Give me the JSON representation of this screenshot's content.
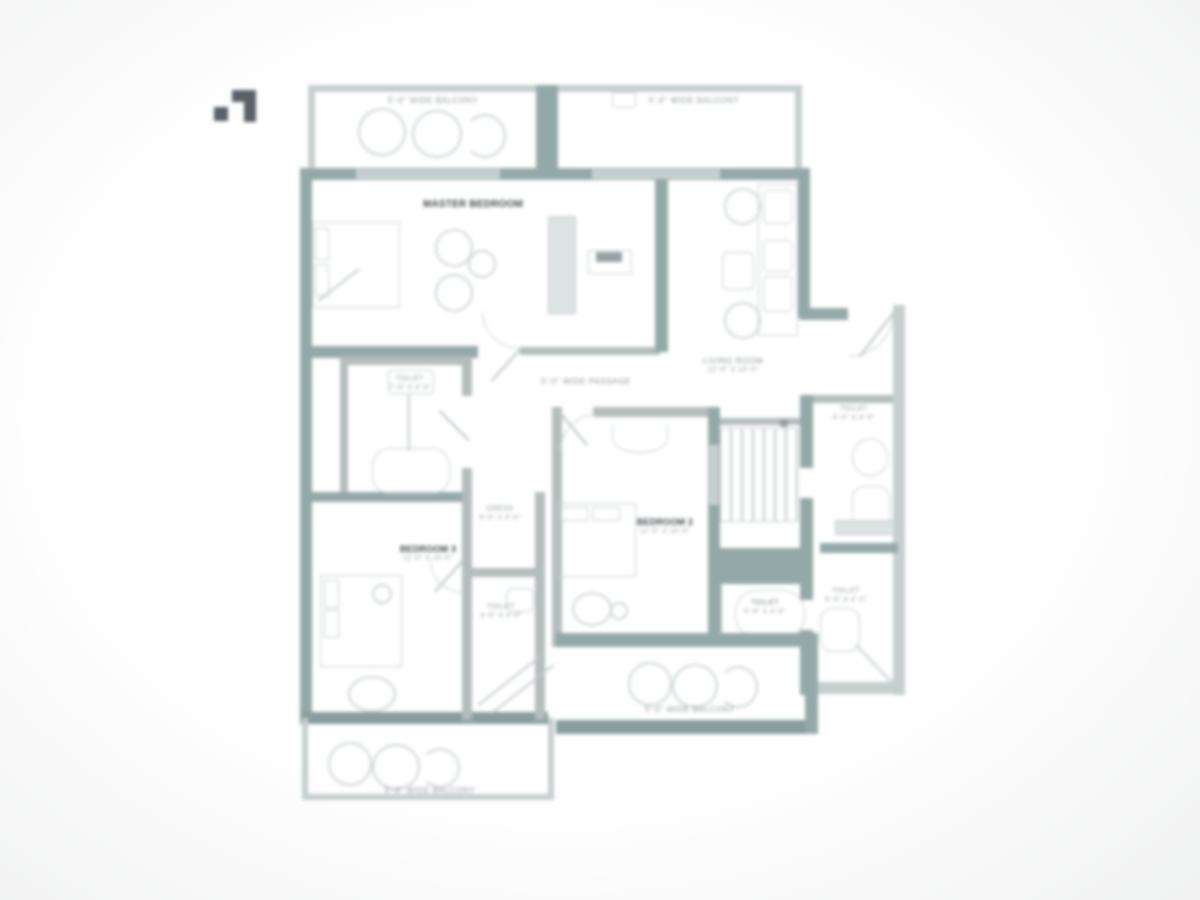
{
  "page": {
    "background": "#ffffff"
  },
  "colors": {
    "wall": "#93a9a8",
    "wall_dark": "#879e9d",
    "wall_light": "#c6cfce",
    "furniture": "#c9d0d0",
    "label_gray": "#8d9496",
    "label_dark": "#41474a",
    "logo": "#5a6065"
  },
  "balconies": {
    "top_left": {
      "label": "5'-0\" WIDE BALCONY"
    },
    "top_right": {
      "label": "5'-0\" WIDE BALCONY"
    },
    "bottom_right": {
      "label": "5'-0\" WIDE BALCONY"
    },
    "bottom_left": {
      "label": "5'-0\" WIDE BALCONY"
    }
  },
  "rooms": {
    "master_bedroom": {
      "label": "MASTER BEDROOM"
    },
    "passage": {
      "label": "5'-0\" WIDE PASSAGE"
    },
    "living": {
      "label": "LIVING ROOM",
      "dim": "12'-6\" X 10'-0\""
    },
    "toilet_main": {
      "label": "TOILET",
      "dim": "7'-0\" X 4'-6\""
    },
    "toilet_entry": {
      "label": "TOILET",
      "dim": "6'-6\" X 4'-0\""
    },
    "toilet_stairs": {
      "label": "TOILET",
      "dim": "5'-0\" X 4'-0\""
    },
    "toilet_right": {
      "label": "TOILET",
      "dim": "5'-6\" X 4'-0\""
    },
    "toilet_small": {
      "label": "TOILET",
      "dim": "4'-6\" X 4'-0\""
    },
    "dress": {
      "label": "DRESS",
      "dim": "5'-0\" X 4'-0\""
    },
    "bedroom_2": {
      "label": "BEDROOM 2",
      "dim": "11'-0\" X 10'-0\""
    },
    "bedroom_3": {
      "label": "BEDROOM 3",
      "dim": "11'-0\" X 10'-0\""
    }
  }
}
